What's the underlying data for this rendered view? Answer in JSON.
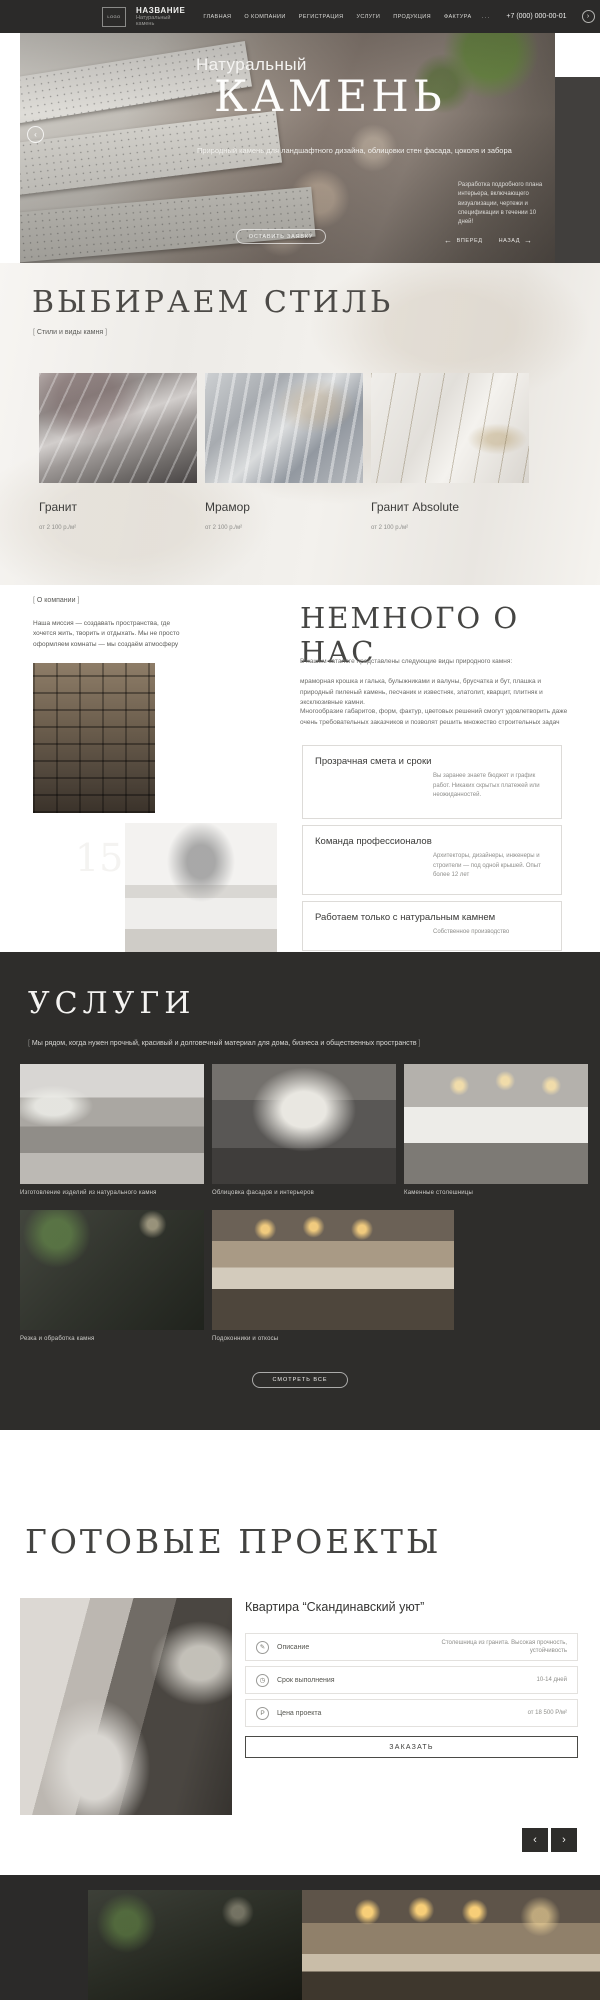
{
  "theme": {
    "dark": "#2b2a29",
    "services_bg": "#2e2d2b",
    "text": "#3a3a3a",
    "muted": "#8e8e8a"
  },
  "header": {
    "logo_box": "LOGO",
    "brand": "НАЗВАНИЕ",
    "brand_sub": "Натуральный камень",
    "nav": [
      {
        "label": "ГЛАВНАЯ"
      },
      {
        "label": "О КОМПАНИИ"
      },
      {
        "label": "РЕГИСТРАЦИЯ"
      },
      {
        "label": "УСЛУГИ"
      },
      {
        "label": "ПРОДУКЦИЯ"
      },
      {
        "label": "ФАКТУРА"
      }
    ],
    "menu_dots": "...",
    "phone": "+7 (000) 000-00-01",
    "arrow": "›"
  },
  "hero": {
    "title_line1": "Натуральный",
    "title_line2": "КАМЕНЬ",
    "subtitle": "Природный камень для ландшафтного дизайна, облицовки стен фасада, цоколя и забора",
    "side_note": "Разработка подробного плана интерьера, включающего визуализации, чертежи и спецификации в течении 10 дней!",
    "circle_arrow": "‹",
    "cta": "ОСТАВИТЬ ЗАЯВКУ",
    "prev_arrow": "←",
    "prev_label": "ВПЕРЕД",
    "next_label": "НАЗАД",
    "next_arrow": "→"
  },
  "styles_section": {
    "title": "ВЫБИРАЕМ СТИЛЬ",
    "tag": "Стили и виды камня",
    "cards": [
      {
        "name": "Гранит",
        "price": "от 2 100 р./м²"
      },
      {
        "name": "Мрамор",
        "price": "от 2 100 р./м²"
      },
      {
        "name": "Гранит Absolute",
        "price": "от 2 100 р./м²"
      }
    ]
  },
  "about": {
    "tag": "О компании",
    "mission": "Наша миссия — создавать пространства, где хочется жить, творить и отдыхать. Мы не просто оформляем комнаты — мы создаём атмосферу",
    "experience_number": "15",
    "experience_label": "ЛЕТ ОПЫТА РАБОТЫ",
    "title": "НЕМНОГО О НАС",
    "p1": "В нашем каталоге представлены следующие виды природного камня:",
    "p2": "мраморная крошка и галька, булыжниками и валуны, брусчатка и бут, плашка и природный пиленый камень, песчаник и известняк, златолит, кварцит, плитняк и эксклюзивные камни.",
    "p3": "Многообразие габаритов, форм, фактур, цветовых решений смогут удовлетворить даже очень требовательных заказчиков и позволят решить множество строительных задач",
    "cards": [
      {
        "title": "Прозрачная смета и сроки",
        "text": "Вы заранее знаете бюджет и график работ. Никаких скрытых платежей или неожиданностей."
      },
      {
        "title": "Команда профессионалов",
        "text": "Архитекторы, дизайнеры, инженеры и строители — под одной крышей. Опыт более 12 лет"
      },
      {
        "title": "Работаем только с натуральным камнем",
        "text": "Собственное производство"
      }
    ]
  },
  "services": {
    "title": "УСЛУГИ",
    "tag": "Мы рядом, когда нужен прочный, красивый и долговечный материал для дома, бизнеса и общественных пространств",
    "items": [
      {
        "caption": "Изготовление изделий из натурального камня"
      },
      {
        "caption": "Облицовка фасадов и интерьеров"
      },
      {
        "caption": "Каменные столешницы"
      },
      {
        "caption": "Резка и обработка камня"
      },
      {
        "caption": "Подоконники и откосы"
      }
    ],
    "cta": "СМОТРЕТЬ ВСЕ"
  },
  "projects": {
    "title": "ГОТОВЫЕ ПРОЕКТЫ",
    "project_name": "Квартира “Скандинавский уют”",
    "specs": [
      {
        "icon": "description-icon",
        "glyph": "✎",
        "label": "Описание",
        "value": "Столешница из гранита. Высокая прочность, устойчивость"
      },
      {
        "icon": "clock-icon",
        "glyph": "◷",
        "label": "Срок выполнения",
        "value": "10-14 дней"
      },
      {
        "icon": "price-icon",
        "glyph": "Р",
        "label": "Цена проекта",
        "value": "от 18 500 Р/м²"
      }
    ],
    "cta": "ЗАКАЗАТЬ",
    "prev": "‹",
    "next": "›"
  }
}
